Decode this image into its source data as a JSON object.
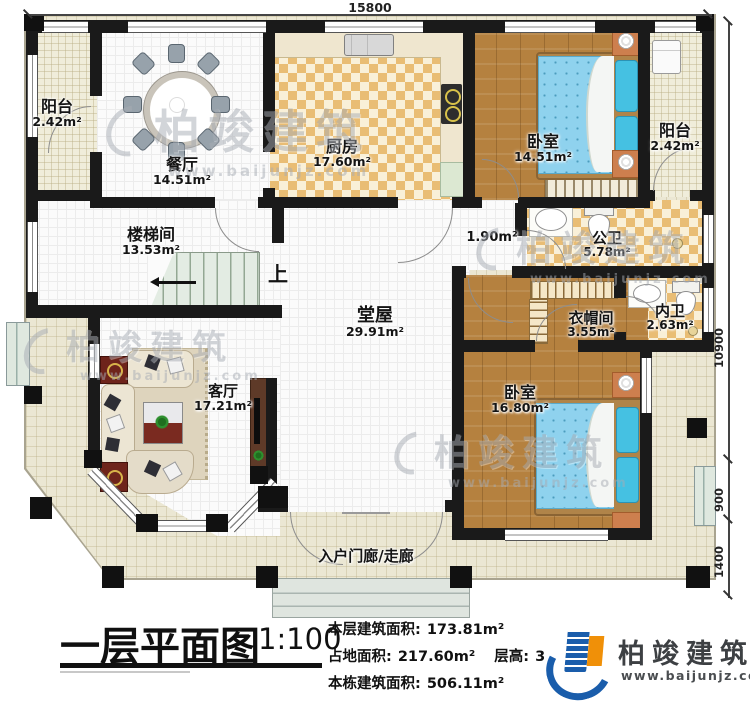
{
  "dims": {
    "top": "15800",
    "right_main": "10900",
    "right_mid": "900",
    "right_low": "1400"
  },
  "rooms": {
    "balcony_left": {
      "name": "阳台",
      "area": "2.42m²"
    },
    "dining": {
      "name": "餐厅",
      "area": "14.51m²"
    },
    "kitchen": {
      "name": "厨房",
      "area": "17.60m²"
    },
    "bedroom1": {
      "name": "卧室",
      "area": "14.51m²"
    },
    "balcony_right": {
      "name": "阳台",
      "area": "2.42m²"
    },
    "stairwell": {
      "name": "楼梯间",
      "area": "13.53m²"
    },
    "hall": {
      "name": "堂屋",
      "area": "29.91m²"
    },
    "corridor": {
      "area": "1.90m²"
    },
    "public_bath": {
      "name": "公卫",
      "area": "5.78m²"
    },
    "private_bath": {
      "name": "内卫",
      "area": "2.63m²"
    },
    "cloakroom": {
      "name": "衣帽间",
      "area": "3.55m²"
    },
    "bedroom2": {
      "name": "卧室",
      "area": "16.80m²"
    },
    "living": {
      "name": "客厅",
      "area": "17.21m²"
    },
    "porch": {
      "name": "入户门廊/走廊"
    }
  },
  "stairs": {
    "up_label": "上"
  },
  "title_block": {
    "title": "一层平面图",
    "scale": "1:100",
    "lines": [
      {
        "label": "本层建筑面积:",
        "value": "173.81m²"
      },
      {
        "label": "占地面积:",
        "value": "217.60m²"
      },
      {
        "label": "层高:",
        "value": "3"
      },
      {
        "label": "本栋建筑面积:",
        "value": "506.11m²"
      }
    ]
  },
  "brand": {
    "name": "柏竣建筑",
    "website": "www.baijunjz.com"
  },
  "watermark": {
    "name": "柏竣建筑",
    "website": "www.baijunjz.com"
  },
  "colors": {
    "wall": "#1a1a1a",
    "wood": "#b5813f",
    "checker": "#e9bd74",
    "deck": "#ebe7d3",
    "bed": "#8fd2ee",
    "logo_blue": "#1a5dab",
    "logo_orange": "#f09008"
  }
}
